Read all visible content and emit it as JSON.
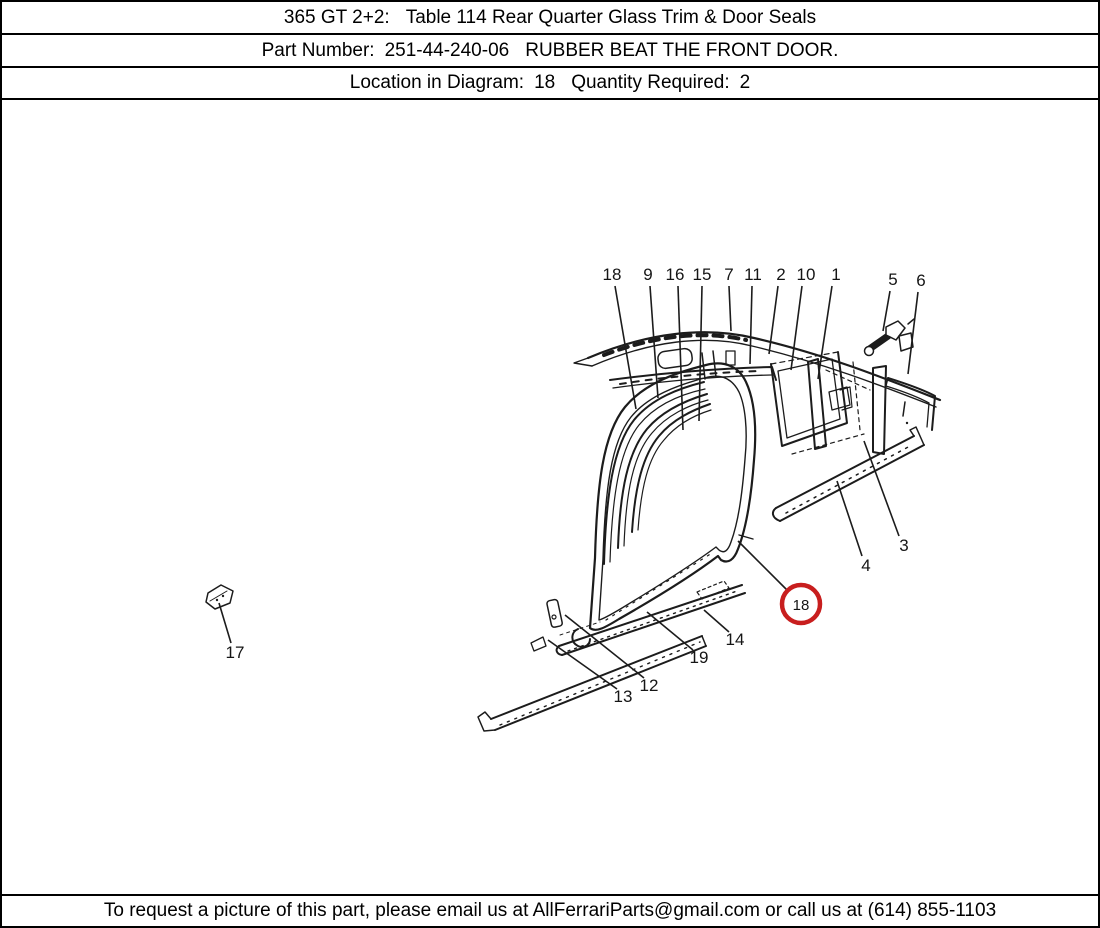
{
  "page": {
    "background": "#ffffff",
    "border_color": "#000000",
    "ink_color": "#1c1c1c",
    "highlight_color": "#c81e1e"
  },
  "header": {
    "model": "365 GT 2+2:",
    "table_title": "Table 114 Rear Quarter Glass Trim & Door Seals",
    "part_number_label": "Part Number:",
    "part_number": "251-44-240-06",
    "part_description": "RUBBER BEAT THE FRONT DOOR.",
    "location_label": "Location in Diagram:",
    "location": "18",
    "quantity_label": "Quantity Required:",
    "quantity": "2"
  },
  "footer": {
    "text": "To request a picture of this part, please email us at AllFerrariParts@gmail.com or call us at (614) 855-1103"
  },
  "diagram": {
    "highlight": {
      "number": "18",
      "cx": 799,
      "cy": 602,
      "r": 19,
      "leader": {
        "x1": 786,
        "y1": 589,
        "x2": 736,
        "y2": 539
      }
    },
    "callouts": [
      {
        "n": "18",
        "x": 610,
        "y": 272,
        "lx1": 613,
        "ly1": 284,
        "lx2": 634,
        "ly2": 407
      },
      {
        "n": "9",
        "x": 646,
        "y": 272,
        "lx1": 648,
        "ly1": 284,
        "lx2": 656,
        "ly2": 396
      },
      {
        "n": "16",
        "x": 673,
        "y": 272,
        "lx1": 676,
        "ly1": 284,
        "lx2": 681,
        "ly2": 428
      },
      {
        "n": "15",
        "x": 700,
        "y": 272,
        "lx1": 700,
        "ly1": 284,
        "lx2": 697,
        "ly2": 419
      },
      {
        "n": "7",
        "x": 727,
        "y": 272,
        "lx1": 727,
        "ly1": 284,
        "lx2": 729,
        "ly2": 329
      },
      {
        "n": "11",
        "x": 751,
        "y": 272,
        "lx1": 750,
        "ly1": 284,
        "lx2": 748,
        "ly2": 362
      },
      {
        "n": "2",
        "x": 779,
        "y": 272,
        "lx1": 776,
        "ly1": 284,
        "lx2": 767,
        "ly2": 352
      },
      {
        "n": "10",
        "x": 804,
        "y": 272,
        "lx1": 800,
        "ly1": 284,
        "lx2": 789,
        "ly2": 368
      },
      {
        "n": "1",
        "x": 834,
        "y": 272,
        "lx1": 830,
        "ly1": 284,
        "lx2": 816,
        "ly2": 377
      },
      {
        "n": "5",
        "x": 891,
        "y": 277,
        "lx1": 888,
        "ly1": 289,
        "lx2": 881,
        "ly2": 329
      },
      {
        "n": "6",
        "x": 919,
        "y": 278,
        "lx1": 916,
        "ly1": 290,
        "lx2": 906,
        "ly2": 372
      },
      {
        "n": "3",
        "x": 902,
        "y": 543,
        "lx1": 897,
        "ly1": 534,
        "lx2": 862,
        "ly2": 439
      },
      {
        "n": "4",
        "x": 864,
        "y": 563,
        "lx1": 860,
        "ly1": 554,
        "lx2": 835,
        "ly2": 479
      },
      {
        "n": "17",
        "x": 233,
        "y": 650,
        "lx1": 229,
        "ly1": 641,
        "lx2": 217,
        "ly2": 601
      },
      {
        "n": "13",
        "x": 621,
        "y": 694,
        "lx1": 615,
        "ly1": 687,
        "lx2": 546,
        "ly2": 638
      },
      {
        "n": "12",
        "x": 647,
        "y": 683,
        "lx1": 642,
        "ly1": 676,
        "lx2": 563,
        "ly2": 613
      },
      {
        "n": "19",
        "x": 697,
        "y": 655,
        "lx1": 691,
        "ly1": 648,
        "lx2": 645,
        "ly2": 610
      },
      {
        "n": "14",
        "x": 733,
        "y": 637,
        "lx1": 727,
        "ly1": 630,
        "lx2": 702,
        "ly2": 608
      }
    ]
  }
}
